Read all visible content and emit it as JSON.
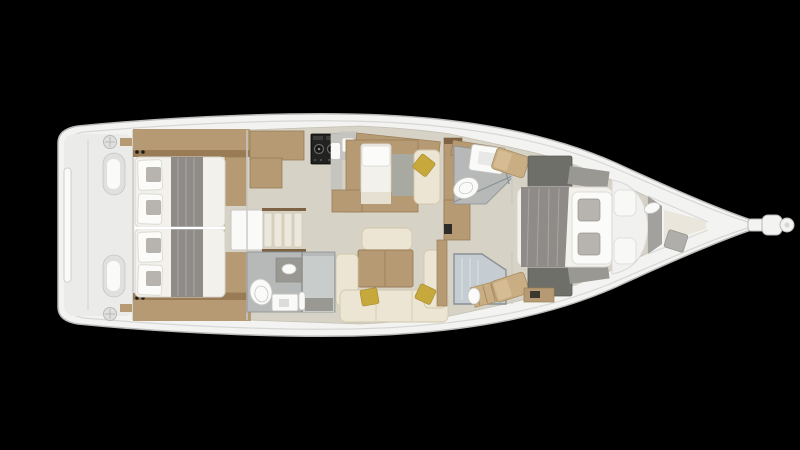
{
  "scene": {
    "kind": "yacht-interior-floor-plan",
    "view": "overhead",
    "orientation": "bow-right-stern-left",
    "visible_text": "none"
  },
  "palette": {
    "bg": "#000000",
    "hull": "#f3f3f1",
    "hullEdge": "#b9b9b7",
    "rim": "#d7d7d5",
    "wall": "#c9c9c7",
    "cockpit": "#ebebe9",
    "cockpitItem": "#e0e0de",
    "sole": "#d7d2c6",
    "soleLight": "#eae6dc",
    "wood": "#b69a74",
    "woodDark": "#997c55",
    "woodDeep": "#7d6344",
    "mattress": "#f3f1ec",
    "mattressEdge": "#d8d5cf",
    "blanket": "#8e8b88",
    "blanketLight": "#aaa7a3",
    "pillow": "#fbfbf9",
    "pillowGray": "#b7b3ae",
    "headFloor": "#b6b9b7",
    "headFloorLight": "#c8cccb",
    "showerFloor": "#c5cdd2",
    "fixture": "#fafaf8",
    "fixtureEdge": "#c5c5c3",
    "sofa": "#ece5d3",
    "sofaEdge": "#d2c7ac",
    "yellow": "#c7a83c",
    "stove": "#222220",
    "grayCab": "#9a9893",
    "wardrobe": "#6e6f68",
    "grayWall": "#a3a19d",
    "cushionTan": "#c9ae84",
    "padGray": "#a8aaa2",
    "counterGray": "#c6c4bf",
    "tread": "#ebe8dd",
    "accentRed": "#7a3b2e",
    "glass": "#8a9094"
  },
  "regions": [
    {
      "id": "swim-platform-cockpit",
      "note": "twin helm consoles and winches at stern"
    },
    {
      "id": "aft-cabin-port",
      "note": "double berth, gray runner, pillows aft"
    },
    {
      "id": "aft-cabin-starboard",
      "note": "double berth, gray runner, pillows aft"
    },
    {
      "id": "companionway",
      "note": "white engine box and four steps"
    },
    {
      "id": "galley",
      "note": "L wood counter, two-burner stove, sink"
    },
    {
      "id": "aft-head",
      "note": "toilet, vanity, shower tray"
    },
    {
      "id": "salon",
      "note": "nav daybed, dinette table, cream L-sofa, mustard pillows"
    },
    {
      "id": "forward-head",
      "note": "shower tray, toilet, glass partition"
    },
    {
      "id": "forward-shower",
      "note": "glass stall with teak bench"
    },
    {
      "id": "owner-cabin",
      "note": "island bed, pillows toward bow, wardrobes"
    },
    {
      "id": "bow-locker",
      "note": "anchor locker and bowsprit"
    }
  ]
}
